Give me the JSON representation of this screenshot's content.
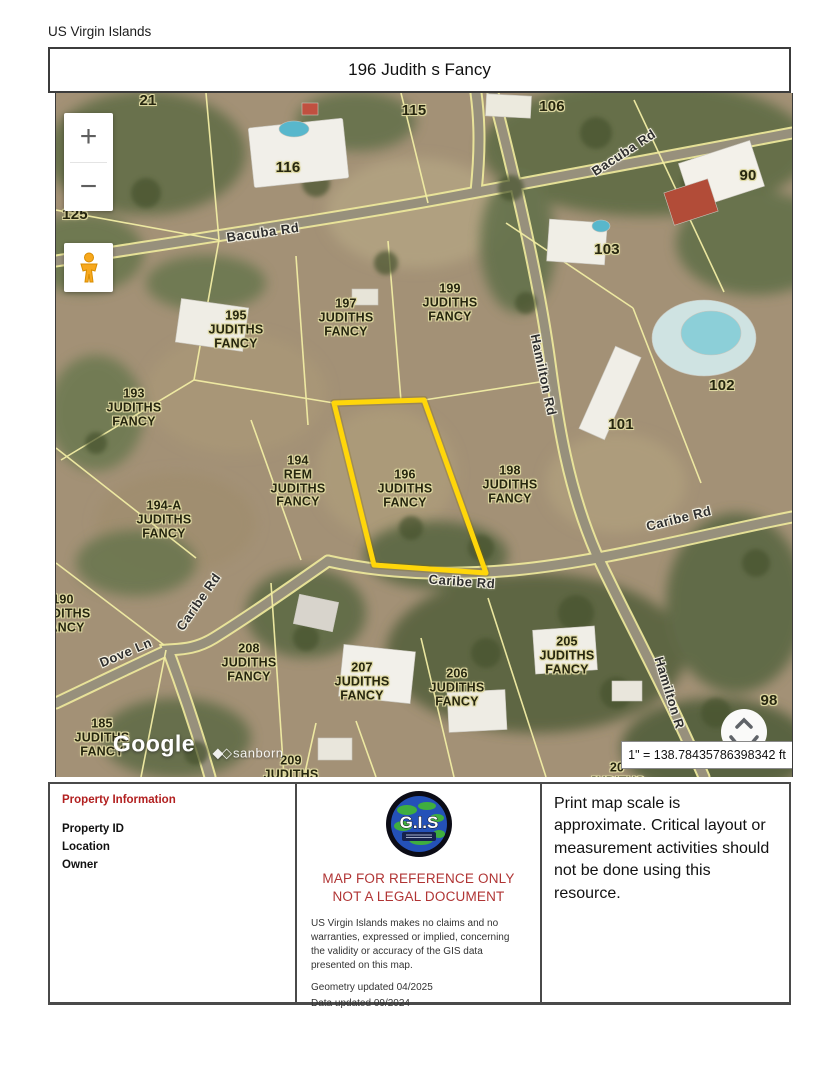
{
  "page": {
    "region_label": "US Virgin Islands"
  },
  "header": {
    "title": "196 Judith s Fancy"
  },
  "map": {
    "highlighted_parcel": "196",
    "controls": {
      "zoom_in": "+",
      "zoom_out": "−"
    },
    "scale_text": "1\" = 138.78435786398342 ft",
    "attribution": {
      "google": "Google",
      "sanborn": "sanborn"
    },
    "labels": [
      {
        "text": "21",
        "x": 92,
        "y": 8,
        "kind": "num"
      },
      {
        "text": "115",
        "x": 358,
        "y": 18,
        "kind": "num"
      },
      {
        "text": "106",
        "x": 496,
        "y": 14,
        "kind": "num"
      },
      {
        "text": "116",
        "x": 232,
        "y": 75,
        "kind": "num"
      },
      {
        "text": "90",
        "x": 692,
        "y": 83,
        "kind": "num"
      },
      {
        "text": "125",
        "x": 19,
        "y": 122,
        "kind": "num"
      },
      {
        "text": "103",
        "x": 551,
        "y": 157,
        "kind": "num"
      },
      {
        "text": "195\nJUDITHS\nFANCY",
        "x": 180,
        "y": 237,
        "kind": "parcel"
      },
      {
        "text": "197\nJUDITHS\nFANCY",
        "x": 290,
        "y": 225,
        "kind": "parcel"
      },
      {
        "text": "199\nJUDITHS\nFANCY",
        "x": 394,
        "y": 210,
        "kind": "parcel"
      },
      {
        "text": "102",
        "x": 666,
        "y": 293,
        "kind": "num"
      },
      {
        "text": "101",
        "x": 565,
        "y": 332,
        "kind": "num"
      },
      {
        "text": "193\nJUDITHS\nFANCY",
        "x": 78,
        "y": 315,
        "kind": "parcel"
      },
      {
        "text": "194\nREM\nJUDITHS\nFANCY",
        "x": 242,
        "y": 389,
        "kind": "parcel"
      },
      {
        "text": "196\nJUDITHS\nFANCY",
        "x": 349,
        "y": 396,
        "kind": "parcel"
      },
      {
        "text": "198\nJUDITHS\nFANCY",
        "x": 454,
        "y": 392,
        "kind": "parcel"
      },
      {
        "text": "194-A\nJUDITHS\nFANCY",
        "x": 108,
        "y": 427,
        "kind": "parcel"
      },
      {
        "text": "190\nJUDITHS\nFANCY",
        "x": 7,
        "y": 521,
        "kind": "parcel"
      },
      {
        "text": "208\nJUDITHS\nFANCY",
        "x": 193,
        "y": 570,
        "kind": "parcel"
      },
      {
        "text": "205\nJUDITHS\nFANCY",
        "x": 511,
        "y": 563,
        "kind": "parcel"
      },
      {
        "text": "207\nJUDITHS\nFANCY",
        "x": 306,
        "y": 589,
        "kind": "parcel"
      },
      {
        "text": "206\nJUDITHS\nFANCY",
        "x": 401,
        "y": 595,
        "kind": "parcel"
      },
      {
        "text": "98",
        "x": 713,
        "y": 608,
        "kind": "num"
      },
      {
        "text": "185\nJUDITHS\nFANCY",
        "x": 46,
        "y": 645,
        "kind": "parcel"
      },
      {
        "text": "209\nJUDITHS\nFANCY",
        "x": 235,
        "y": 682,
        "kind": "parcel"
      },
      {
        "text": "20\nJUDITHS",
        "x": 561,
        "y": 682,
        "kind": "parcel"
      },
      {
        "text": "Bacuba Rd",
        "x": 207,
        "y": 140,
        "rot": -8,
        "kind": "road"
      },
      {
        "text": "Bacuba Rd",
        "x": 568,
        "y": 60,
        "rot": -33,
        "kind": "road"
      },
      {
        "text": "Hamilton Rd",
        "x": 487,
        "y": 282,
        "rot": 78,
        "kind": "road"
      },
      {
        "text": "Caribe Rd",
        "x": 623,
        "y": 426,
        "rot": -14,
        "kind": "road"
      },
      {
        "text": "Caribe Rd",
        "x": 406,
        "y": 489,
        "rot": 4,
        "kind": "road"
      },
      {
        "text": "Caribe Rd",
        "x": 143,
        "y": 509,
        "rot": -55,
        "kind": "road"
      },
      {
        "text": "Dove Ln",
        "x": 70,
        "y": 560,
        "rot": -23,
        "kind": "road"
      },
      {
        "text": "Hamilton R",
        "x": 613,
        "y": 600,
        "rot": 73,
        "kind": "road"
      }
    ]
  },
  "footer": {
    "property_info": {
      "heading": "Property Information",
      "fields": [
        "Property ID",
        "Location",
        "Owner"
      ]
    },
    "center": {
      "logo_text": "G.I.S",
      "warning_line1": "MAP FOR REFERENCE ONLY",
      "warning_line2": "NOT A LEGAL DOCUMENT",
      "disclaimer": "US Virgin Islands makes no claims and no warranties, expressed or implied, concerning the validity or accuracy of the GIS data presented on this map.",
      "geometry_updated": "Geometry updated 04/2025",
      "data_updated": "Data updated 09/2024"
    },
    "right_note": "Print map scale is approximate. Critical layout or measurement activities should not be done using this resource."
  }
}
